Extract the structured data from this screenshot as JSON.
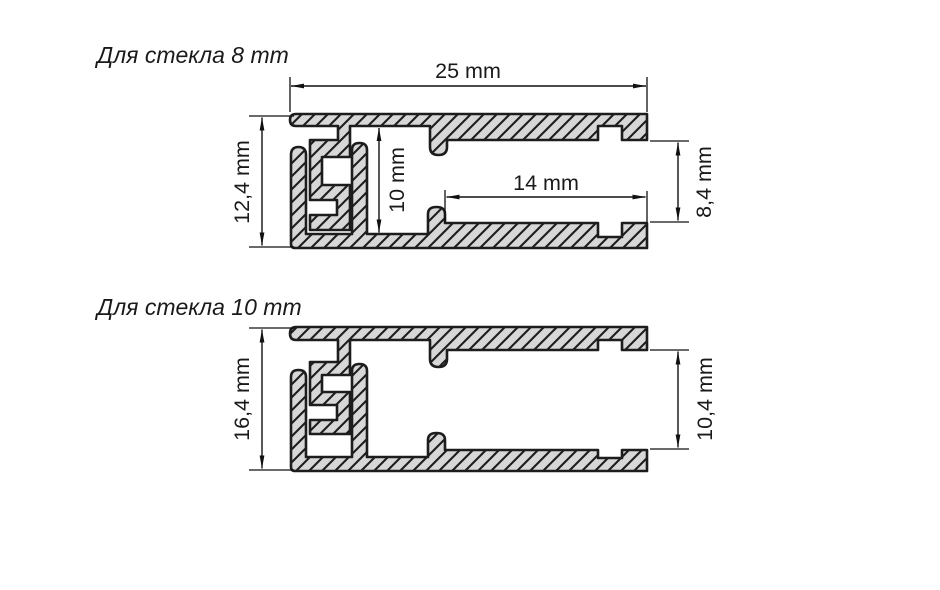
{
  "page": {
    "background": "#ffffff"
  },
  "drawing": {
    "fill_color": "#d7d7d7",
    "line_color": "#1d1d1d",
    "sections": [
      {
        "title": "Для стекла 8 mm",
        "dims": {
          "width": "25 mm",
          "total_height": "12,4 mm",
          "inner_height": "10 mm",
          "pocket_depth": "14 mm",
          "pocket_opening": "8,4 mm"
        }
      },
      {
        "title": "Для стекла 10 mm",
        "dims": {
          "total_height": "16,4 mm",
          "pocket_opening": "10,4 mm"
        }
      }
    ]
  }
}
